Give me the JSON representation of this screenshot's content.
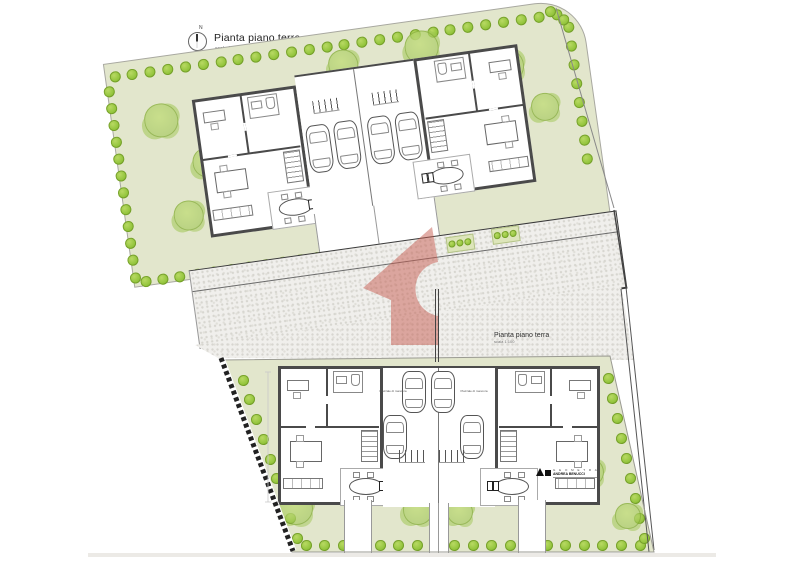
{
  "page": {
    "title": "Pianta piano terra",
    "scale": "scala 1:100"
  },
  "compass": {
    "label": "N"
  },
  "lower_plan_label": {
    "title": "Pianta piano terra",
    "scale": "scala 1:100"
  },
  "court_label": "Piazzale di manovra",
  "logo": {
    "studio": "G E O M E T R A",
    "name": "ANDREA BENUCCI"
  },
  "colors": {
    "garden_green": "#e2e6cc",
    "tree_green": "#92c43b",
    "wall_gray": "#4a4a4a",
    "cobble_gray": "#f0efec",
    "watermark_red": "#c65b50"
  },
  "decor": {
    "tree_rows": [
      {
        "c": "upper",
        "x1": 22,
        "y1": 38,
        "x2": 468,
        "y2": 38,
        "n": 26,
        "d": 11
      },
      {
        "c": "upper",
        "x1": 14,
        "y1": 52,
        "x2": 14,
        "y2": 240,
        "n": 12,
        "d": 11
      },
      {
        "c": "upper",
        "x1": 24,
        "y1": 245,
        "x2": 232,
        "y2": 245,
        "n": 13,
        "d": 11
      },
      {
        "c": "upper",
        "x1": 478,
        "y1": 52,
        "x2": 478,
        "y2": 185,
        "n": 8,
        "d": 11
      },
      {
        "c": "upper",
        "x1": 462,
        "y1": 34,
        "x2": 474,
        "y2": 44,
        "n": 2,
        "d": 11
      },
      {
        "c": "road",
        "x1": 263,
        "y1": 9,
        "x2": 279,
        "y2": 9,
        "n": 3,
        "d": 7
      },
      {
        "c": "road",
        "x1": 309,
        "y1": 7,
        "x2": 325,
        "y2": 7,
        "n": 3,
        "d": 7
      },
      {
        "c": "page",
        "x1": 243,
        "y1": 380,
        "x2": 297,
        "y2": 538,
        "n": 9,
        "d": 11
      },
      {
        "c": "page",
        "x1": 306,
        "y1": 545,
        "x2": 640,
        "y2": 545,
        "n": 19,
        "d": 11
      },
      {
        "c": "page",
        "x1": 608,
        "y1": 378,
        "x2": 644,
        "y2": 538,
        "n": 9,
        "d": 11
      }
    ],
    "tree_clusters": [
      {
        "c": "upper",
        "x": 62,
        "y": 88,
        "d": 34
      },
      {
        "c": "upper",
        "x": 102,
        "y": 136,
        "d": 30
      },
      {
        "c": "upper",
        "x": 76,
        "y": 186,
        "d": 30
      },
      {
        "c": "upper",
        "x": 250,
        "y": 58,
        "d": 30
      },
      {
        "c": "upper",
        "x": 330,
        "y": 52,
        "d": 34
      },
      {
        "c": "upper",
        "x": 412,
        "y": 82,
        "d": 34
      },
      {
        "c": "upper",
        "x": 444,
        "y": 128,
        "d": 28
      },
      {
        "c": "page",
        "x": 296,
        "y": 508,
        "d": 34
      },
      {
        "c": "page",
        "x": 418,
        "y": 510,
        "d": 30
      },
      {
        "c": "page",
        "x": 460,
        "y": 512,
        "d": 26
      },
      {
        "c": "page",
        "x": 590,
        "y": 472,
        "d": 28
      },
      {
        "c": "page",
        "x": 628,
        "y": 516,
        "d": 26
      }
    ]
  }
}
